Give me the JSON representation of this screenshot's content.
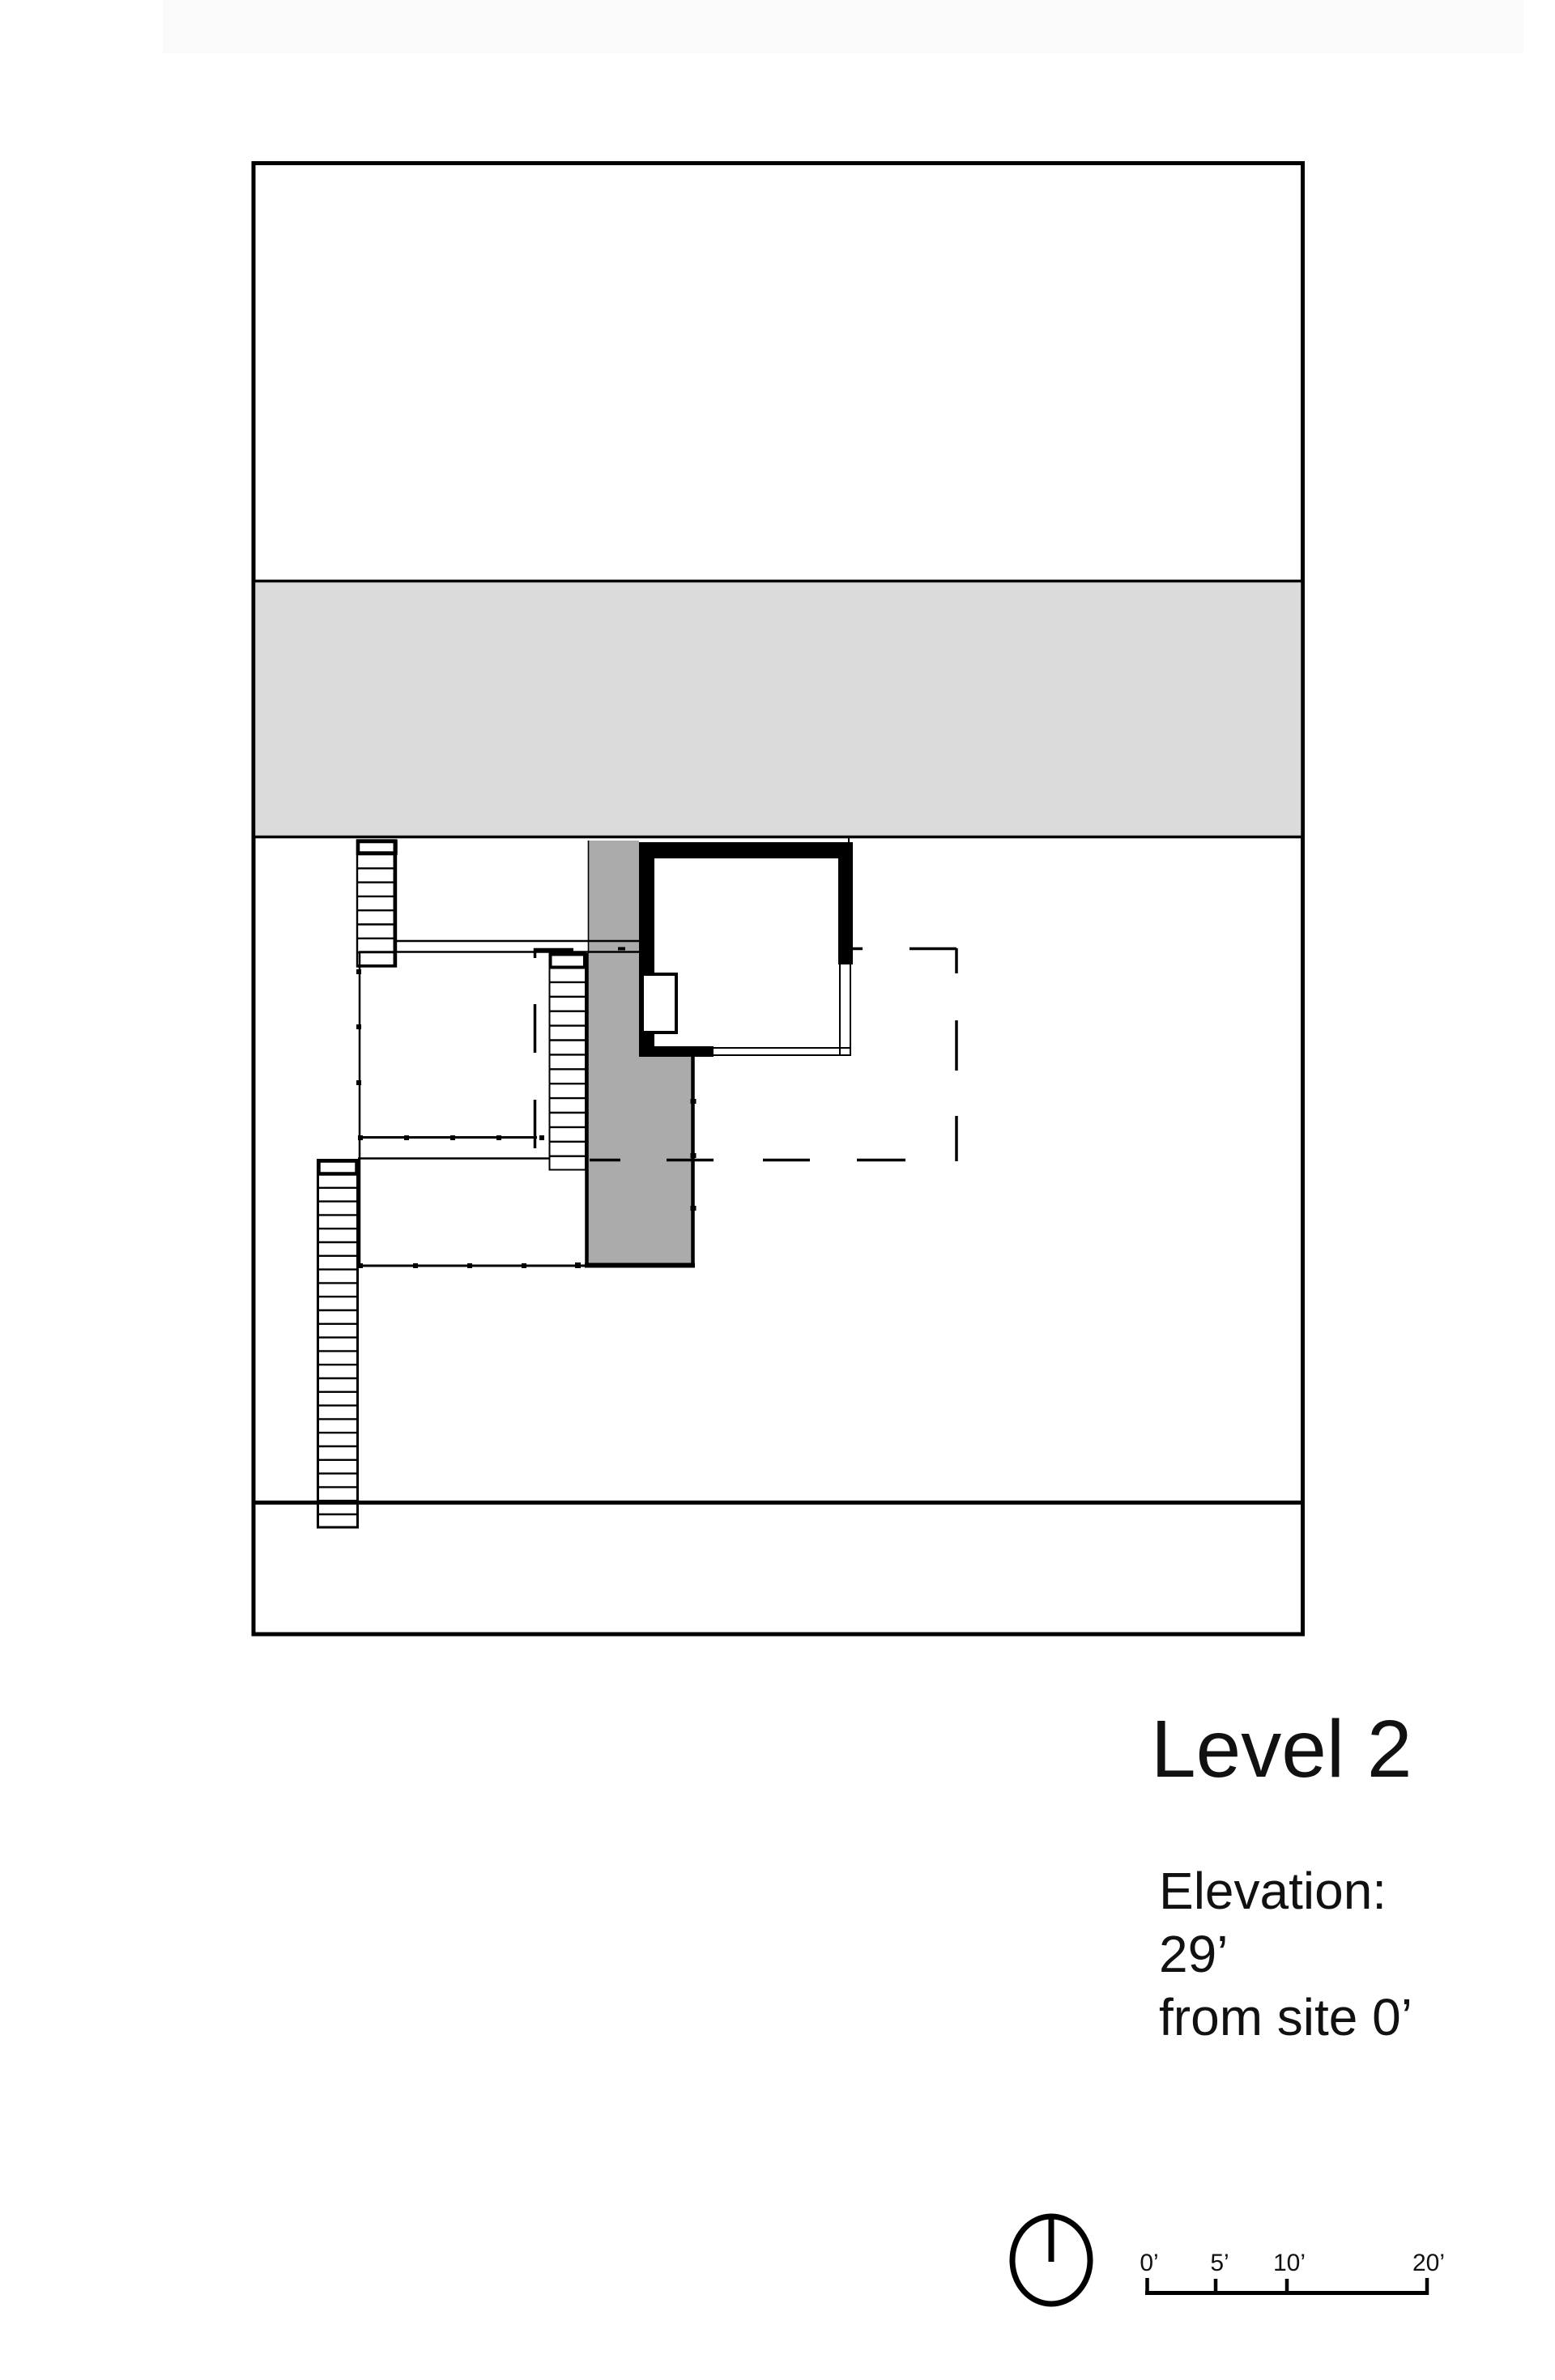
{
  "title": {
    "text": "Level 2"
  },
  "elevation_note": {
    "line1": "Elevation:",
    "line2": "29’",
    "line3": "from site 0’"
  },
  "scale_bar": {
    "labels": [
      "0’",
      "5’",
      "10’",
      "20’"
    ]
  },
  "north_arrow": {
    "icon": "north-arrow-icon"
  },
  "colors": {
    "band_gray": "#dbdbdb",
    "deck_gray": "#ababab",
    "line_black": "#000000",
    "paper_white": "#ffffff"
  }
}
